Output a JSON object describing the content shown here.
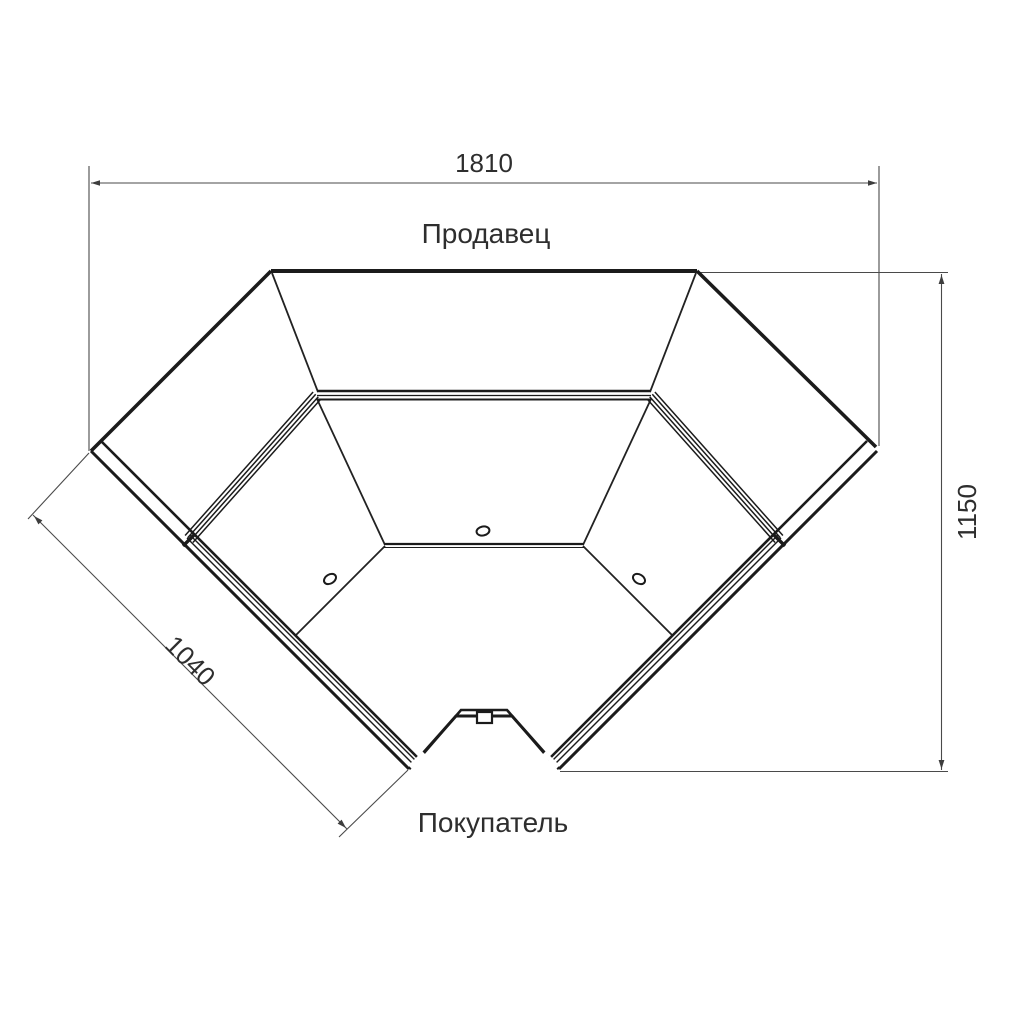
{
  "diagram": {
    "type": "technical-plan-drawing",
    "subject": "corner display counter, top view",
    "labels": {
      "seller": "Продавец",
      "buyer": "Покупатель"
    },
    "dimensions": {
      "top_width": "1810",
      "left_face_length": "1040",
      "right_height": "1150"
    },
    "colors": {
      "background": "#ffffff",
      "outline": "#1b1b1b",
      "dimension_line": "#4a4a4a",
      "text": "#2e2e2e"
    }
  }
}
